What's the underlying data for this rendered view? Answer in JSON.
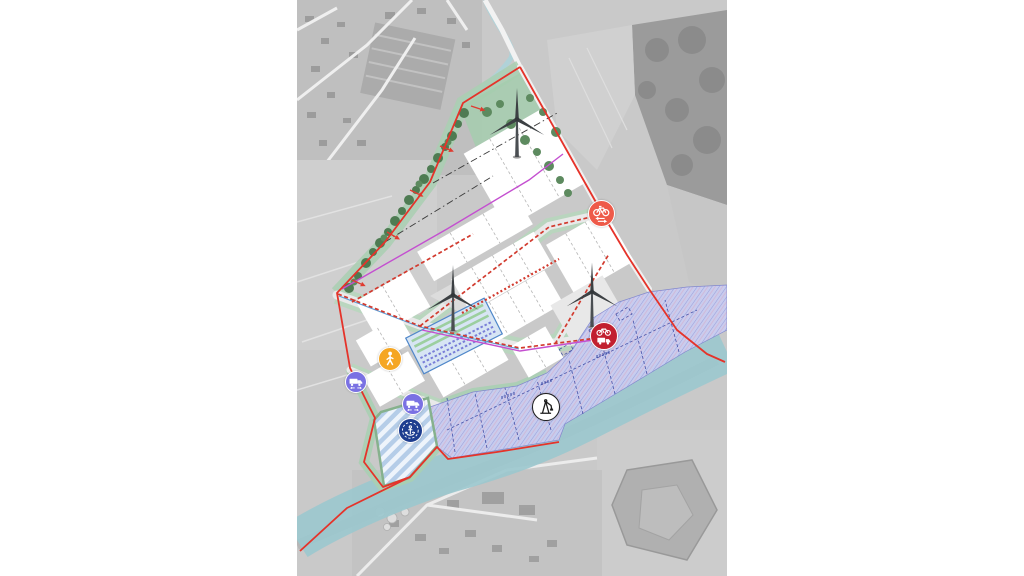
{
  "canvas": {
    "width": 1024,
    "height": 576,
    "background": "#ffffff"
  },
  "plan": {
    "kind": "industrial-site-development-plan-over-aerial-photo",
    "boundary": {
      "color": "#e5332a",
      "style": "solid"
    },
    "zones": [
      {
        "id": "harbor-industrial-hatch-zone",
        "fill": "#c9cdf1",
        "hatch_color": "#979ddf",
        "hatch_accent": "#d8a8c8"
      },
      {
        "id": "water-retention-striped-zone",
        "stripe_light": "#eef4fb",
        "stripe_blue": "#b5cde8",
        "border": "#86b18d"
      },
      {
        "id": "green-buffer",
        "fill": "#a9cfb2",
        "tree_color": "#4e7b52"
      },
      {
        "id": "building-plots",
        "fill": "#ffffff",
        "division_dash": "#b5b5b5"
      },
      {
        "id": "parking-facility",
        "fill": "#d7e5f4",
        "border": "#4f87c9",
        "row_green": "#9ccf9f",
        "row_purple": "#7a7fd8"
      },
      {
        "id": "river",
        "fill": "#9cc8ce"
      },
      {
        "id": "stream",
        "fill": "#abd4da"
      }
    ],
    "routes": [
      {
        "id": "freight-route",
        "color": "#d23a2e",
        "style": "dashed"
      },
      {
        "id": "cycle-route",
        "color": "#c44fd0",
        "style": "solid"
      },
      {
        "id": "slow-traffic-path",
        "color": "#3a3a3a",
        "style": "dash-dot"
      },
      {
        "id": "water-channel",
        "color": "#5b9bd5",
        "style": "solid"
      }
    ],
    "markers": [
      {
        "name": "cycle-route-marker",
        "glyph": "bicycle-arrows",
        "x": 304,
        "y": 213,
        "d": 27,
        "bg": "#ee5a49",
        "ring": "#ffffff",
        "fg": "#ffffff"
      },
      {
        "name": "cycle-truck-crossing-marker",
        "glyph": "bicycle-truck",
        "x": 307,
        "y": 336,
        "d": 28,
        "bg": "#c2202f",
        "ring": "#ffffff",
        "fg": "#ffffff"
      },
      {
        "name": "pedestrian-access-marker",
        "glyph": "pedestrian",
        "x": 93,
        "y": 359,
        "d": 24,
        "bg": "#f5a623",
        "ring": "#ffffff",
        "fg": "#ffffff"
      },
      {
        "name": "truck-access-west-marker",
        "glyph": "truck",
        "x": 59,
        "y": 382,
        "d": 22,
        "bg": "#7a71e3",
        "ring": "#ffffff",
        "fg": "#ffffff"
      },
      {
        "name": "truck-access-south-marker",
        "glyph": "truck",
        "x": 116,
        "y": 404,
        "d": 22,
        "bg": "#7a71e3",
        "ring": "#ffffff",
        "fg": "#ffffff"
      },
      {
        "name": "water-basin-marker",
        "glyph": "anchor-badge",
        "x": 113,
        "y": 430,
        "d": 25,
        "bg": "#1e3d8f",
        "ring": "#ffffff",
        "fg": "#ffffff"
      },
      {
        "name": "harbor-crane-marker",
        "glyph": "crane",
        "x": 249,
        "y": 407,
        "d": 28,
        "bg": "#ffffff",
        "ring": "#1b1b1b",
        "fg": "#1b1b1b"
      }
    ],
    "wind_turbines": [
      {
        "x": 220,
        "y": 157,
        "scale": 1.05
      },
      {
        "x": 156,
        "y": 331,
        "scale": 1.0
      },
      {
        "x": 295,
        "y": 327,
        "scale": 0.98
      }
    ]
  }
}
